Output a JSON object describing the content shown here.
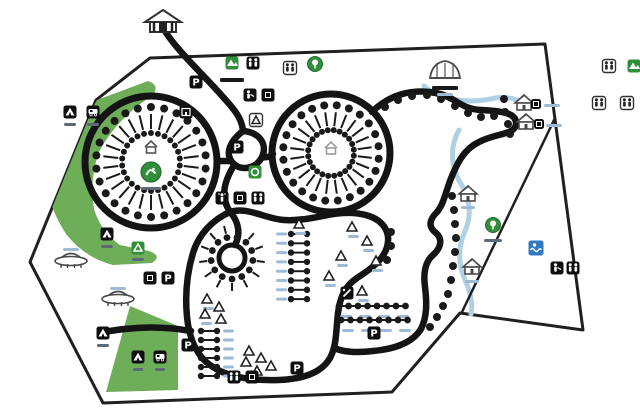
{
  "map": {
    "title": "campground-site-map",
    "colors": {
      "bg": "#ffffff",
      "road": "#161616",
      "boundary": "#222222",
      "green_area": "#6cae55",
      "green_icon": "#2f8f39",
      "stream": "#aecfe3",
      "dot": "#1c1c1c",
      "label_blue": "#9db9d6",
      "label_dark": "#5c6a77",
      "label_black": "#1c1c1c",
      "blue_icon": "#2e7cc3",
      "structure": "#4a4a4a",
      "parking_glyph": "P"
    },
    "boundary_points": "150,58 545,44 583,330 460,313 392,392 103,403 30,262 96,100",
    "inner_line": "M555,118 L462,312",
    "green_areas": [
      "M97,100 L148,81 Q160,85 153,95 Q116,119 99,152 Q89,180 94,209 Q101,232 120,245 L149,251 Q163,256 152,263 L113,265 Q85,258 66,234 Q52,212 47,190 Z",
      "M130,306 L178,326 L178,390 L106,392 Z"
    ],
    "streams": [
      "M424,86 C438,99 466,104 490,99 C502,96 512,97 521,102",
      "M459,130 C449,148 451,168 461,184 C470,199 472,215 465,231 C458,247 458,264 465,280 C471,293 473,304 471,314"
    ],
    "roads": [
      "M163,28 C176,50 203,74 223,97 C235,110 242,119 243,131",
      "M243,131 C259,132 268,144 262,157 C256,169 240,172 232,162 C225,153 230,141 243,131",
      "M231,161 L218,161",
      "M262,157 C268,158 271,156 273,154",
      "M233,167 C223,184 221,198 230,212",
      "M372,112 C388,96 410,88 436,93 C456,97 460,109 481,110 C502,111 517,113 516,124 C515,135 496,133 479,142 C464,149 457,163 450,181 C445,195 443,205 437,212 C429,220 428,227 436,233 C443,239 441,248 433,255 C426,261 423,272 425,287 C427,303 427,317 421,329 C413,342 396,349 373,351 C357,353 342,352 335,348",
      "M230,212 C214,219 199,233 193,253 C187,273 185,296 187,317 C189,337 196,355 210,365 C226,377 252,381 279,380 C305,379 322,372 330,358 C337,345 336,329 338,313 C340,297 345,286 357,278 C369,270 383,261 387,247 C391,233 384,221 369,216 C354,211 338,213 328,215 C312,218 298,221 284,220 C266,219 246,206 230,212 Z",
      "M231,213 C240,224 240,236 235,245",
      "M110,331 C140,326 168,327 191,331"
    ],
    "circles": [
      {
        "name": "pitch-loop-west",
        "cx": 151,
        "cy": 162,
        "r": 66,
        "sw": 7,
        "n": 26,
        "dotOut": 55,
        "tickOut": 48,
        "tickIn": 33,
        "dotIn": 29
      },
      {
        "name": "pitch-loop-east",
        "cx": 331,
        "cy": 153,
        "r": 59,
        "sw": 7,
        "n": 24,
        "dotOut": 48,
        "tickOut": 41,
        "tickIn": 27,
        "dotIn": 23
      },
      {
        "name": "pitch-hub-south",
        "cx": 232,
        "cy": 258,
        "r": 13,
        "sw": 5,
        "n": 13,
        "dotOut": 21,
        "tickOut": 33,
        "tickIn": 25,
        "dotIn": 0
      }
    ],
    "road_dots": [
      [
        385,
        107
      ],
      [
        398,
        100
      ],
      [
        412,
        96
      ],
      [
        427,
        95
      ],
      [
        441,
        99
      ],
      [
        455,
        106
      ],
      [
        468,
        113
      ],
      [
        481,
        117
      ],
      [
        494,
        116
      ],
      [
        505,
        112
      ],
      [
        504,
        99
      ],
      [
        508,
        124
      ],
      [
        510,
        134
      ],
      [
        452,
        196
      ],
      [
        454,
        210
      ],
      [
        455,
        224
      ],
      [
        456,
        238
      ],
      [
        455,
        252
      ],
      [
        453,
        266
      ],
      [
        451,
        280
      ],
      [
        448,
        294
      ],
      [
        443,
        306
      ],
      [
        437,
        317
      ],
      [
        430,
        327
      ],
      [
        391,
        232
      ],
      [
        391,
        246
      ],
      [
        387,
        260
      ]
    ],
    "chains": [
      {
        "x0": 339,
        "y": 306,
        "n": 8,
        "dx": 9.5,
        "labels": [
          [
            346,
            315
          ],
          [
            365,
            315
          ],
          [
            384,
            315
          ],
          [
            403,
            315
          ]
        ]
      },
      {
        "x0": 341,
        "y": 320,
        "n": 8,
        "dx": 9.5,
        "labels": [
          [
            348,
            329
          ],
          [
            367,
            329
          ],
          [
            386,
            329
          ],
          [
            405,
            329
          ]
        ]
      }
    ],
    "ladders": [
      {
        "x": 299,
        "y0": 234,
        "n": 8,
        "dy": 9.3,
        "labelX": 281
      },
      {
        "x": 209,
        "y0": 331,
        "n": 6,
        "dy": 9.0,
        "labelX": 228
      }
    ],
    "tents": [
      [
        299,
        224,
        1
      ],
      [
        352,
        227,
        1
      ],
      [
        367,
        241,
        1
      ],
      [
        341,
        256,
        1
      ],
      [
        376,
        261,
        1
      ],
      [
        329,
        276,
        1
      ],
      [
        362,
        291,
        1
      ],
      [
        207,
        299,
        1
      ],
      [
        219,
        307,
        0
      ],
      [
        205,
        314,
        1
      ],
      [
        221,
        319,
        0
      ],
      [
        249,
        351,
        0
      ],
      [
        261,
        358,
        0
      ],
      [
        246,
        362,
        0
      ],
      [
        271,
        366,
        0
      ],
      [
        257,
        371,
        0
      ]
    ],
    "structures": [
      {
        "name": "gatehouse-icon",
        "t": "gate",
        "x": 163,
        "y": 20
      },
      {
        "name": "pavilion-icon",
        "t": "marquee",
        "x": 445,
        "y": 72
      },
      {
        "name": "cabin-icon",
        "t": "hut",
        "x": 468,
        "y": 194
      },
      {
        "name": "cabin-icon",
        "t": "hut",
        "x": 472,
        "y": 267
      },
      {
        "name": "cabin-icon",
        "t": "hut",
        "x": 524,
        "y": 103
      },
      {
        "name": "cabin-icon",
        "t": "hut",
        "x": 526,
        "y": 122
      },
      {
        "name": "big-tent-icon",
        "t": "saucer",
        "x": 71,
        "y": 260
      },
      {
        "name": "big-tent-icon",
        "t": "saucer",
        "x": 118,
        "y": 298
      }
    ],
    "icons": [
      {
        "name": "playground-sign-icon",
        "t": "green-sq",
        "x": 232,
        "y": 63
      },
      {
        "name": "toilets-icon",
        "t": "wc",
        "x": 253,
        "y": 63
      },
      {
        "name": "toilets-outline-icon",
        "t": "wc-out",
        "x": 290,
        "y": 68
      },
      {
        "name": "tree-icon",
        "t": "tree-round",
        "x": 315,
        "y": 64
      },
      {
        "name": "parking-icon",
        "t": "p",
        "x": 196,
        "y": 82
      },
      {
        "name": "dishwashing-icon",
        "t": "person",
        "x": 250,
        "y": 95
      },
      {
        "name": "utility-icon",
        "t": "dark",
        "x": 268,
        "y": 95
      },
      {
        "name": "building-icon",
        "t": "bld",
        "x": 186,
        "y": 112
      },
      {
        "name": "shelter-icon",
        "t": "tri-out",
        "x": 256,
        "y": 120
      },
      {
        "name": "parking-icon",
        "t": "p",
        "x": 237,
        "y": 147
      },
      {
        "name": "info-icon",
        "t": "ring",
        "x": 255,
        "y": 172
      },
      {
        "name": "shower-icon",
        "t": "shower",
        "x": 222,
        "y": 198
      },
      {
        "name": "utility-icon",
        "t": "dark",
        "x": 240,
        "y": 198
      },
      {
        "name": "toilets-icon",
        "t": "wc",
        "x": 258,
        "y": 198
      },
      {
        "name": "tent-sign-icon",
        "t": "tent-sign",
        "x": 70,
        "y": 112
      },
      {
        "name": "caravan-sign-icon",
        "t": "van-sign",
        "x": 93,
        "y": 112
      },
      {
        "name": "tent-sign-icon",
        "t": "tent-sign",
        "x": 107,
        "y": 234
      },
      {
        "name": "recycling-icon",
        "t": "recycle",
        "x": 138,
        "y": 248
      },
      {
        "name": "utility-icon",
        "t": "dark",
        "x": 150,
        "y": 278
      },
      {
        "name": "parking-icon",
        "t": "p",
        "x": 168,
        "y": 278
      },
      {
        "name": "tent-sign-icon",
        "t": "tent-sign",
        "x": 103,
        "y": 333
      },
      {
        "name": "tent-sign-icon",
        "t": "tent-sign",
        "x": 138,
        "y": 357
      },
      {
        "name": "caravan-sign-icon",
        "t": "van-sign",
        "x": 160,
        "y": 357
      },
      {
        "name": "parking-icon",
        "t": "p",
        "x": 188,
        "y": 345
      },
      {
        "name": "parking-icon",
        "t": "p",
        "x": 297,
        "y": 368
      },
      {
        "name": "toilets-icon",
        "t": "wc",
        "x": 234,
        "y": 377
      },
      {
        "name": "utility-icon",
        "t": "dark",
        "x": 252,
        "y": 377
      },
      {
        "name": "restaurant-icon",
        "t": "knife",
        "x": 347,
        "y": 293
      },
      {
        "name": "parking-icon",
        "t": "p",
        "x": 374,
        "y": 333
      },
      {
        "name": "house-icon",
        "t": "house-out",
        "x": 151,
        "y": 147
      },
      {
        "name": "camp-emblem-icon",
        "t": "emblem",
        "x": 151,
        "y": 172
      },
      {
        "name": "house-icon",
        "t": "house-out",
        "x": 331,
        "y": 148,
        "faint": 1
      },
      {
        "name": "eco-icon",
        "t": "tree-round",
        "x": 493,
        "y": 225
      },
      {
        "name": "swimming-icon",
        "t": "swim",
        "x": 536,
        "y": 248
      },
      {
        "name": "shower-icon",
        "t": "person",
        "x": 557,
        "y": 268
      },
      {
        "name": "toilets-icon",
        "t": "wc",
        "x": 573,
        "y": 268
      },
      {
        "name": "cabin-mini-icon",
        "t": "dark",
        "x": 536,
        "y": 104,
        "s": 10
      },
      {
        "name": "cabin-mini-icon",
        "t": "dark",
        "x": 539,
        "y": 124,
        "s": 10
      },
      {
        "name": "toilets-outline-icon",
        "t": "wc-out",
        "x": 609,
        "y": 66
      },
      {
        "name": "green-sign-icon",
        "t": "green-sq",
        "x": 634,
        "y": 66
      },
      {
        "name": "legend-icon",
        "t": "wc-out",
        "x": 599,
        "y": 103
      },
      {
        "name": "legend-icon",
        "t": "wc-out",
        "x": 627,
        "y": 103
      }
    ],
    "labels": [
      [
        70,
        123,
        12,
        "dark"
      ],
      [
        93,
        123,
        12,
        "dark"
      ],
      [
        107,
        245,
        12,
        "dark"
      ],
      [
        138,
        258,
        12,
        "dark"
      ],
      [
        103,
        344,
        12,
        "dark"
      ],
      [
        138,
        368,
        10,
        "dark"
      ],
      [
        160,
        368,
        10,
        "dark"
      ],
      [
        232,
        78,
        24,
        "black"
      ],
      [
        151,
        187,
        20,
        "dark"
      ],
      [
        445,
        86,
        26,
        "black"
      ],
      [
        445,
        93,
        16,
        "blue"
      ],
      [
        468,
        206,
        14,
        "blue"
      ],
      [
        472,
        280,
        14,
        "blue"
      ],
      [
        493,
        239,
        18,
        "dark"
      ],
      [
        552,
        104,
        16,
        "blue"
      ],
      [
        554,
        124,
        16,
        "blue"
      ],
      [
        71,
        248,
        16,
        "blue"
      ],
      [
        118,
        287,
        16,
        "blue"
      ]
    ]
  }
}
